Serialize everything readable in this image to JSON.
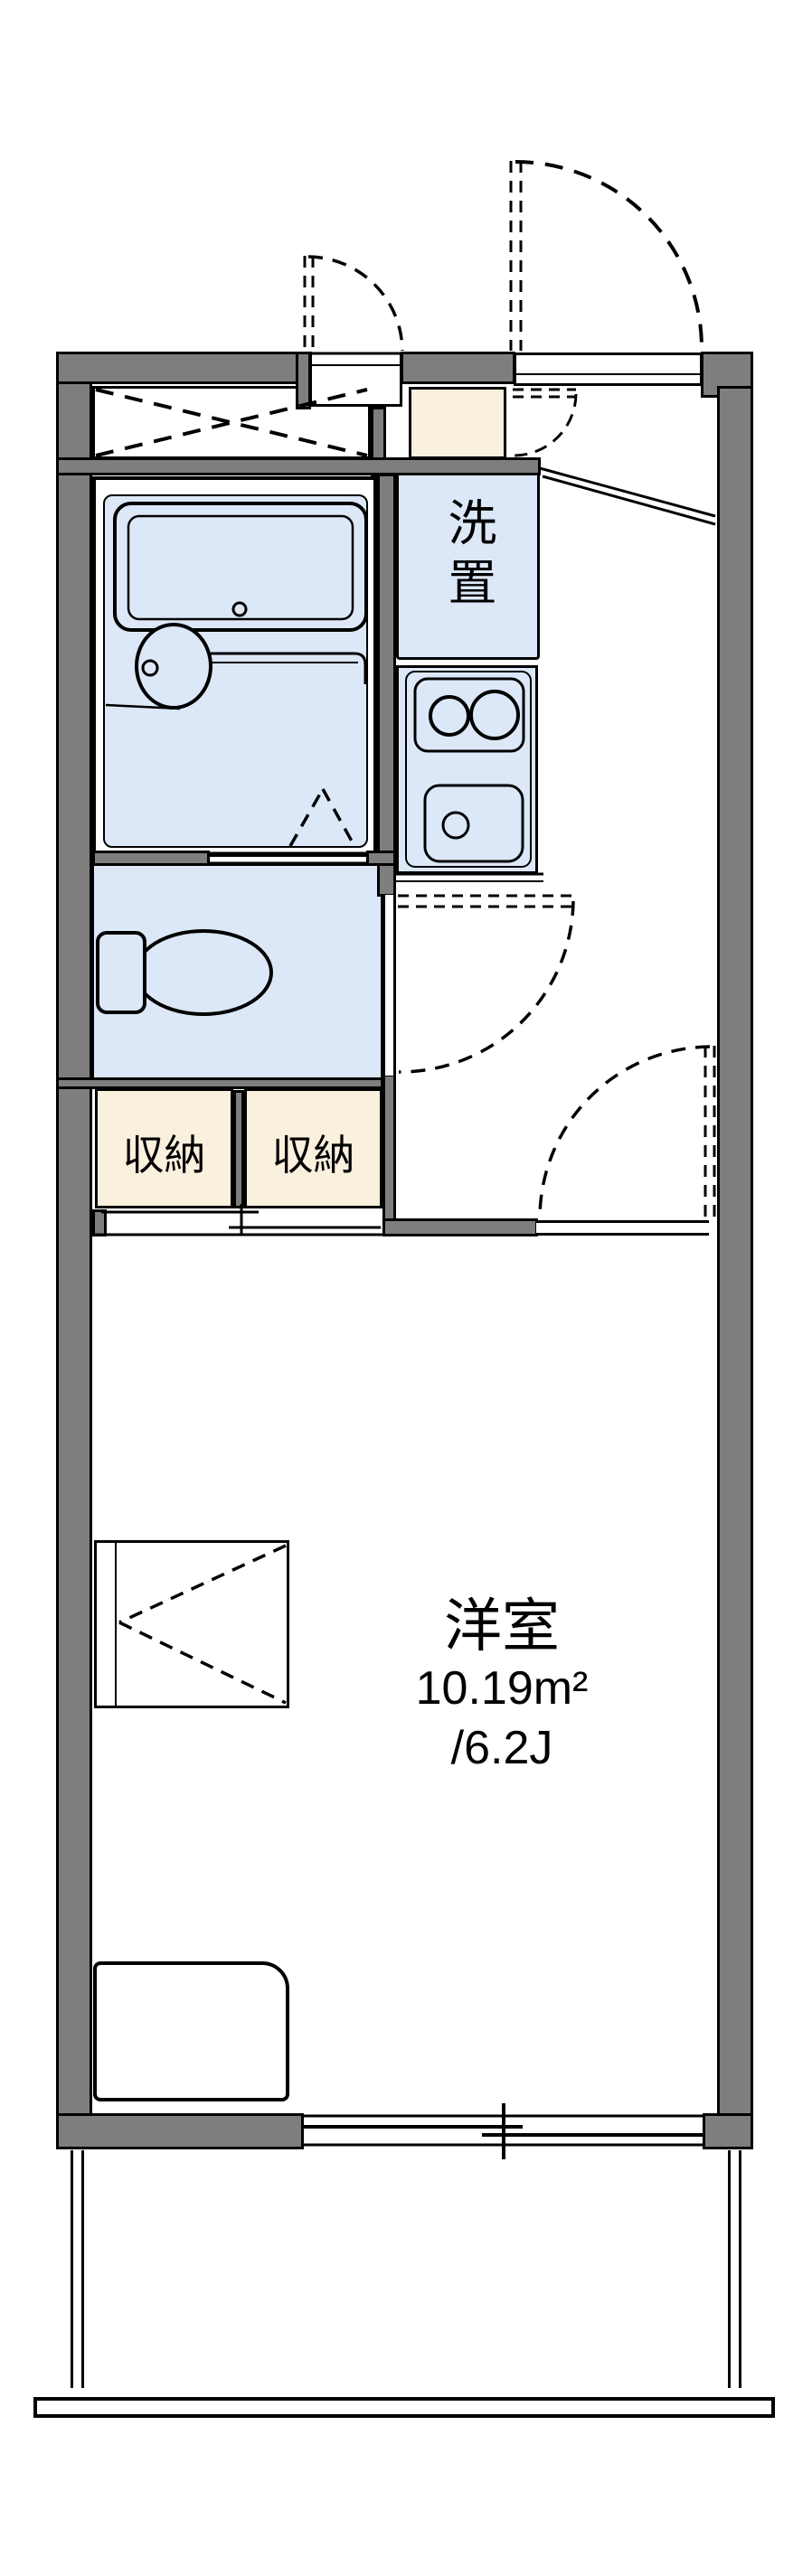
{
  "plan_type": "floorplan",
  "labels": {
    "washer_space": "洗置",
    "storage_left": "収納",
    "storage_right": "収納",
    "room_name": "洋室",
    "room_area_m2": "10.19m²",
    "room_area_tatami": "/6.2J"
  },
  "colors": {
    "wall": "#7E7E7E",
    "line": "#000000",
    "room_blue": "#DCE8F8",
    "storage_cream": "#FAF0DE",
    "bg": "#FFFFFF"
  }
}
